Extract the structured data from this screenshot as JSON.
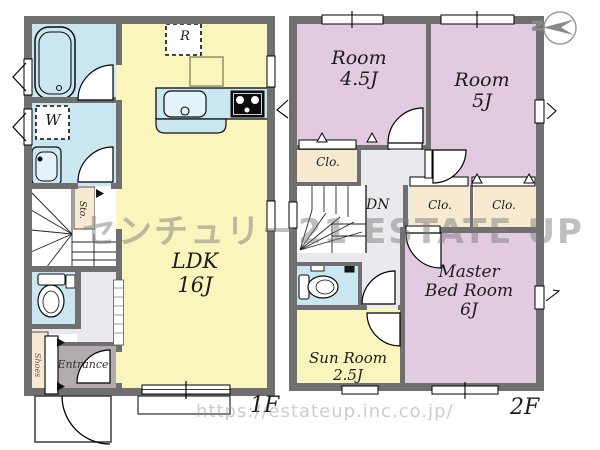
{
  "watermark": {
    "brand": "センチュリー21 ESTATE UP",
    "url": "https://estateup.inc.co.jp/"
  },
  "compass": {
    "north": "N"
  },
  "floor1": {
    "label": "1F",
    "ldk_name": "LDK",
    "ldk_size": "16J",
    "entrance": "Entrance",
    "storage": "Sto.",
    "shoe_storage": "Shoes",
    "washer": "W",
    "refrigerator": "R"
  },
  "floor2": {
    "label": "2F",
    "room1_name": "Room",
    "room1_size": "4.5J",
    "room2_name": "Room",
    "room2_size": "5J",
    "master_line1": "Master",
    "master_line2": "Bed Room",
    "master_size": "6J",
    "sunroom_name": "Sun Room",
    "sunroom_size": "2.5J",
    "closet": "Clo.",
    "down": "DN"
  },
  "colors": {
    "wall": "#6f6f6f",
    "water_blue": "#c9e6f1",
    "living_yellow": "#f9f5bd",
    "bedroom_pink": "#e2cbe1",
    "storage_cream": "#f7ead0",
    "hall_gray": "#eaeaee",
    "entrance_gray": "#b3acac",
    "watermark_gray": "#8f8f8f"
  }
}
